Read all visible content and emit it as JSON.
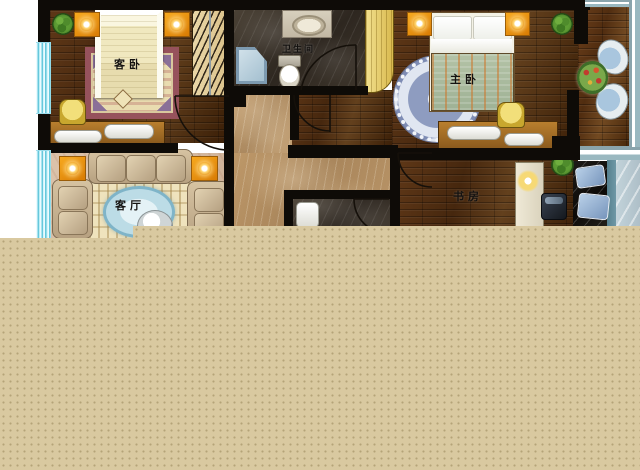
{
  "plan": {
    "type": "apartment-floor-plan",
    "rooms": {
      "guest_bedroom": {
        "label": "客卧"
      },
      "bathroom": {
        "label": "卫生间"
      },
      "master_bedroom": {
        "label": "主卧"
      },
      "living_room": {
        "label": "客厅"
      },
      "study": {
        "label": "书房"
      }
    }
  },
  "palette": {
    "wall": "#0e0b07",
    "wood_floor": "#4f2d12",
    "dark_marble_floor": "#3a322a",
    "beige_marble_corridor": "#b5905f",
    "living_room_floor": "#d6bca4",
    "window_glass_cyan": "#7fd4e4",
    "balcony_frame": "#9ab8c0",
    "lamp_accent_orange": "#ef930c",
    "cabinet_yellow": "#e9d075",
    "master_rug_blue": "#8e9cc0",
    "guest_rug_border": "#96525c",
    "sofa_tan": "#c9b493",
    "pillow_blue": "#8fb0d8",
    "overlay_tan": "#d9c9a0"
  }
}
